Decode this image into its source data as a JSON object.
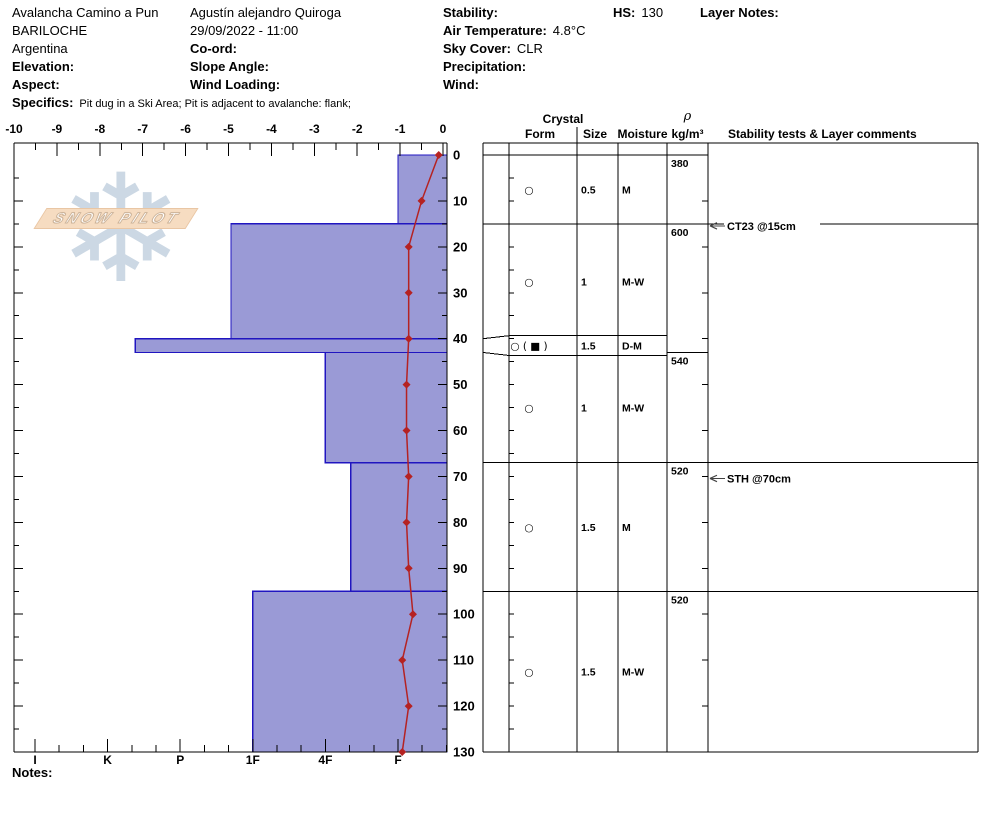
{
  "header": {
    "col1": {
      "title": "Avalancha Camino a Pun",
      "city": "BARILOCHE",
      "country": "Argentina",
      "elevation_label": "Elevation:",
      "aspect_label": "Aspect:",
      "specifics_label": "Specifics:",
      "specifics_value": "Pit dug in a Ski Area; Pit is adjacent to avalanche: flank;"
    },
    "col2": {
      "observer": "Agustín alejandro Quiroga",
      "datetime": "29/09/2022 - 11:00",
      "coord_label": "Co-ord:",
      "slope_angle_label": "Slope Angle:",
      "wind_loading_label": "Wind Loading:"
    },
    "col3": {
      "stability_label": "Stability:",
      "air_temp_label": "Air Temperature:",
      "air_temp_value": "4.8°C",
      "sky_label": "Sky Cover:",
      "sky_value": "CLR",
      "precip_label": "Precipitation:",
      "wind_label": "Wind:"
    },
    "hs_label": "HS:",
    "hs_value": "130",
    "layer_notes_label": "Layer Notes:"
  },
  "watermark": {
    "text": "SNOW PILOT",
    "snowflake": "❄"
  },
  "notes_label": "Notes:",
  "chart_data": {
    "type": "snow-profile",
    "depth_unit": "cm",
    "total_depth": 130,
    "depth_tick_labels": [
      0,
      10,
      20,
      30,
      40,
      50,
      60,
      70,
      80,
      90,
      100,
      110,
      120,
      130
    ],
    "temp_axis": {
      "unit": "°C",
      "min": -10,
      "max": 0,
      "tick_labels": [
        -10,
        -9,
        -8,
        -7,
        -6,
        -5,
        -4,
        -3,
        -2,
        -1,
        0
      ]
    },
    "hardness_scale": [
      {
        "label": "I",
        "num": 6
      },
      {
        "label": "K",
        "num": 5
      },
      {
        "label": "P",
        "num": 4
      },
      {
        "label": "1F",
        "num": 3
      },
      {
        "label": "4F",
        "num": 2
      },
      {
        "label": "F",
        "num": 1
      }
    ],
    "layers": [
      {
        "top": 0,
        "bottom": 15,
        "hardness": "F",
        "hardness_num": 1.0,
        "form": "○",
        "size": "0.5",
        "moisture": "M"
      },
      {
        "top": 15,
        "bottom": 40,
        "hardness": "1F+",
        "hardness_num": 3.3,
        "form": "○",
        "size": "1",
        "moisture": "M-W"
      },
      {
        "top": 40,
        "bottom": 43,
        "hardness": "K-",
        "hardness_num": 4.62,
        "form": "○ ( ■ )",
        "size": "1.5",
        "moisture": "D-M"
      },
      {
        "top": 43,
        "bottom": 67,
        "hardness": "4F",
        "hardness_num": 2.0,
        "form": "○",
        "size": "1",
        "moisture": "M-W"
      },
      {
        "top": 67,
        "bottom": 95,
        "hardness": "4F-",
        "hardness_num": 1.65,
        "form": "○",
        "size": "1.5",
        "moisture": "M"
      },
      {
        "top": 95,
        "bottom": 130,
        "hardness": "1F",
        "hardness_num": 3.0,
        "form": "○",
        "size": "1.5",
        "moisture": "M-W"
      }
    ],
    "density_column": [
      {
        "from": 0,
        "to": 15,
        "value": "380"
      },
      {
        "from": 15,
        "to": 43,
        "value": "600"
      },
      {
        "from": 43,
        "to": 67,
        "value": "540"
      },
      {
        "from": 67,
        "to": 95,
        "value": "520"
      },
      {
        "from": 95,
        "to": 130,
        "value": "520"
      }
    ],
    "temperature_profile": [
      {
        "depth": 0,
        "temp": -0.1
      },
      {
        "depth": 10,
        "temp": -0.5
      },
      {
        "depth": 20,
        "temp": -0.8
      },
      {
        "depth": 30,
        "temp": -0.8
      },
      {
        "depth": 40,
        "temp": -0.8
      },
      {
        "depth": 50,
        "temp": -0.85
      },
      {
        "depth": 60,
        "temp": -0.85
      },
      {
        "depth": 70,
        "temp": -0.8
      },
      {
        "depth": 80,
        "temp": -0.85
      },
      {
        "depth": 90,
        "temp": -0.8
      },
      {
        "depth": 100,
        "temp": -0.7
      },
      {
        "depth": 110,
        "temp": -0.95
      },
      {
        "depth": 120,
        "temp": -0.8
      },
      {
        "depth": 130,
        "temp": -0.95
      }
    ],
    "tests": [
      {
        "label": "CT23 @15cm",
        "depth": 15
      },
      {
        "label": "STH @70cm",
        "depth": 70
      }
    ],
    "table_headers": {
      "crystal": "Crystal",
      "form": "Form",
      "size": "Size",
      "moisture": "Moisture",
      "rho": "ρ",
      "rho_units": "kg/m³",
      "comments": "Stability tests & Layer comments"
    },
    "colors": {
      "bar_fill": "#9a9ad6",
      "bar_border": "#2015c0",
      "temp_line": "#b52222",
      "axis": "#000000",
      "arrow": "#444444"
    }
  }
}
